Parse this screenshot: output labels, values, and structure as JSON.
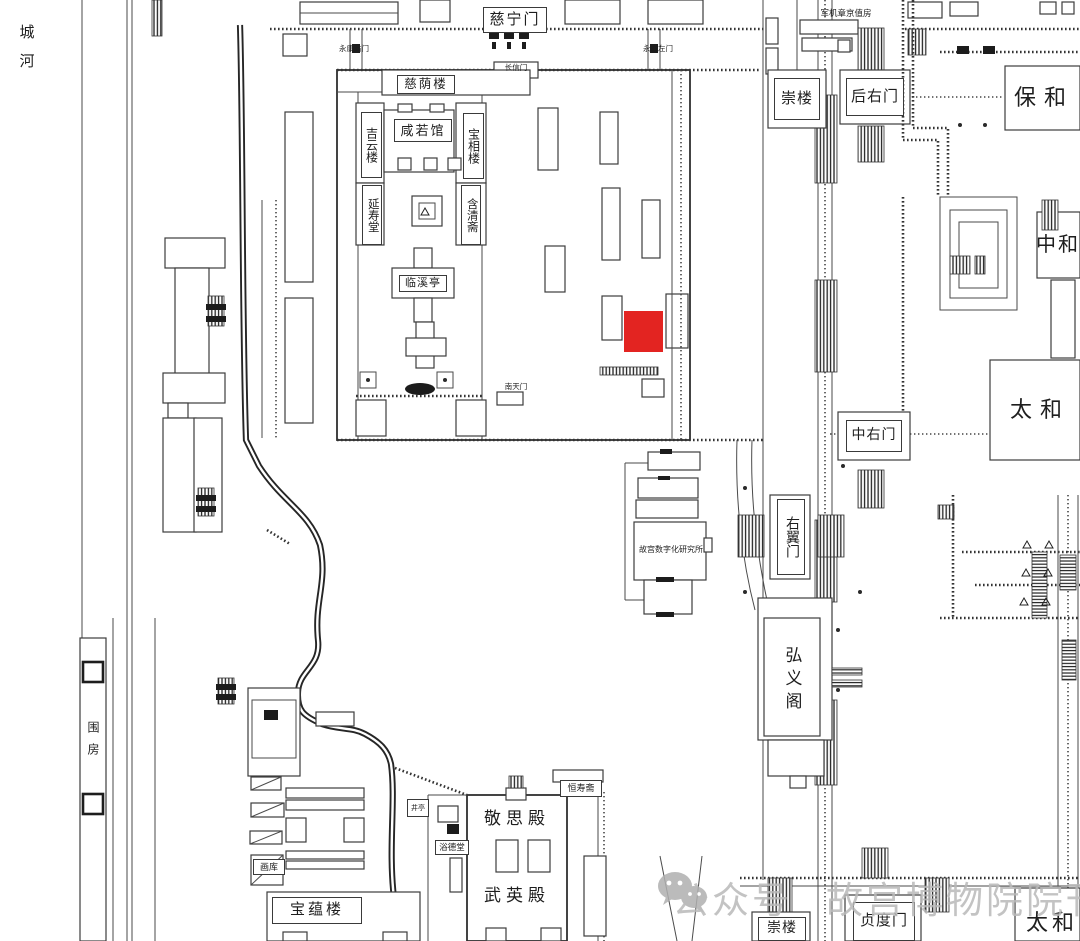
{
  "labels": {
    "moat": "城河",
    "cining_gate": "慈宁门",
    "yongkang_right_gate": "永康右门",
    "changxin_gate": "长信门",
    "yongkang_left_gate": "永康左门",
    "ciyin_tower": "慈荫楼",
    "jiyun_tower": "吉云楼",
    "xianruo_hall": "咸若馆",
    "baoxiang_tower": "宝相楼",
    "yanshou_hall": "延寿堂",
    "hanqing_studio": "含清斋",
    "linxi_pavilion": "临溪亭",
    "nantian_gate": "南天门",
    "junji_duty_room": "军机章京值房",
    "chong_tower_north": "崇楼",
    "houyou_gate": "后右门",
    "baohe_hall": "保和",
    "zhonghe_hall": "中和",
    "taihe_hall": "太和",
    "zhongyou_gate": "中右门",
    "youyi_gate": "右翼门",
    "hongyi_pavilion": "弘义阁",
    "digitization_institute": "故宫数字化研究所",
    "hengshou_studio": "恒寿斋",
    "jingsi_hall": "敬思殿",
    "wuying_hall": "武英殿",
    "yude_hall": "浴德堂",
    "well_pavilion": "井亭",
    "painting_storehouse": "画库",
    "baoyun_tower": "宝蕴楼",
    "wei_fang": "围房",
    "chong_tower_south": "崇楼",
    "zhendu_gate": "贞度门",
    "taihe_gate": "太和"
  },
  "highlight": {
    "color": "#e32421"
  },
  "watermark": {
    "icon": "wechat-icon",
    "platform_label": "公众号",
    "account_name": "故宫博物院院刊",
    "color": "#b9b9b9"
  }
}
